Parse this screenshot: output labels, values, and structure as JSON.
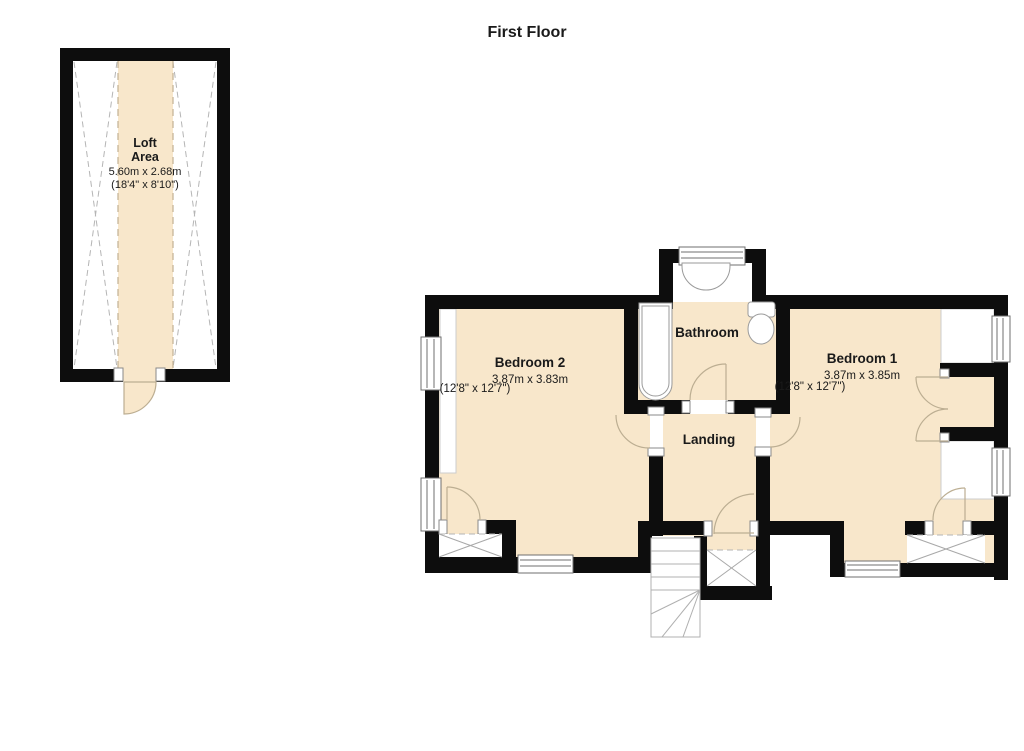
{
  "title": "First Floor",
  "colors": {
    "floor": "#f8e7cb",
    "wall": "#0d0d0d"
  },
  "loft": {
    "line1": "Loft",
    "line2": "Area",
    "metric": "5.60m x 2.68m",
    "imperial": "(18'4\" x 8'10\")"
  },
  "rooms": {
    "bedroom2": {
      "name": "Bedroom 2",
      "metric": "3.87m x 3.83m",
      "imperial": "(12'8\" x 12'7\")"
    },
    "bedroom1": {
      "name": "Bedroom 1",
      "metric": "3.87m x 3.85m",
      "imperial": "(12'8\" x 12'7\")"
    },
    "bathroom": {
      "name": "Bathroom"
    },
    "landing": {
      "name": "Landing"
    }
  }
}
